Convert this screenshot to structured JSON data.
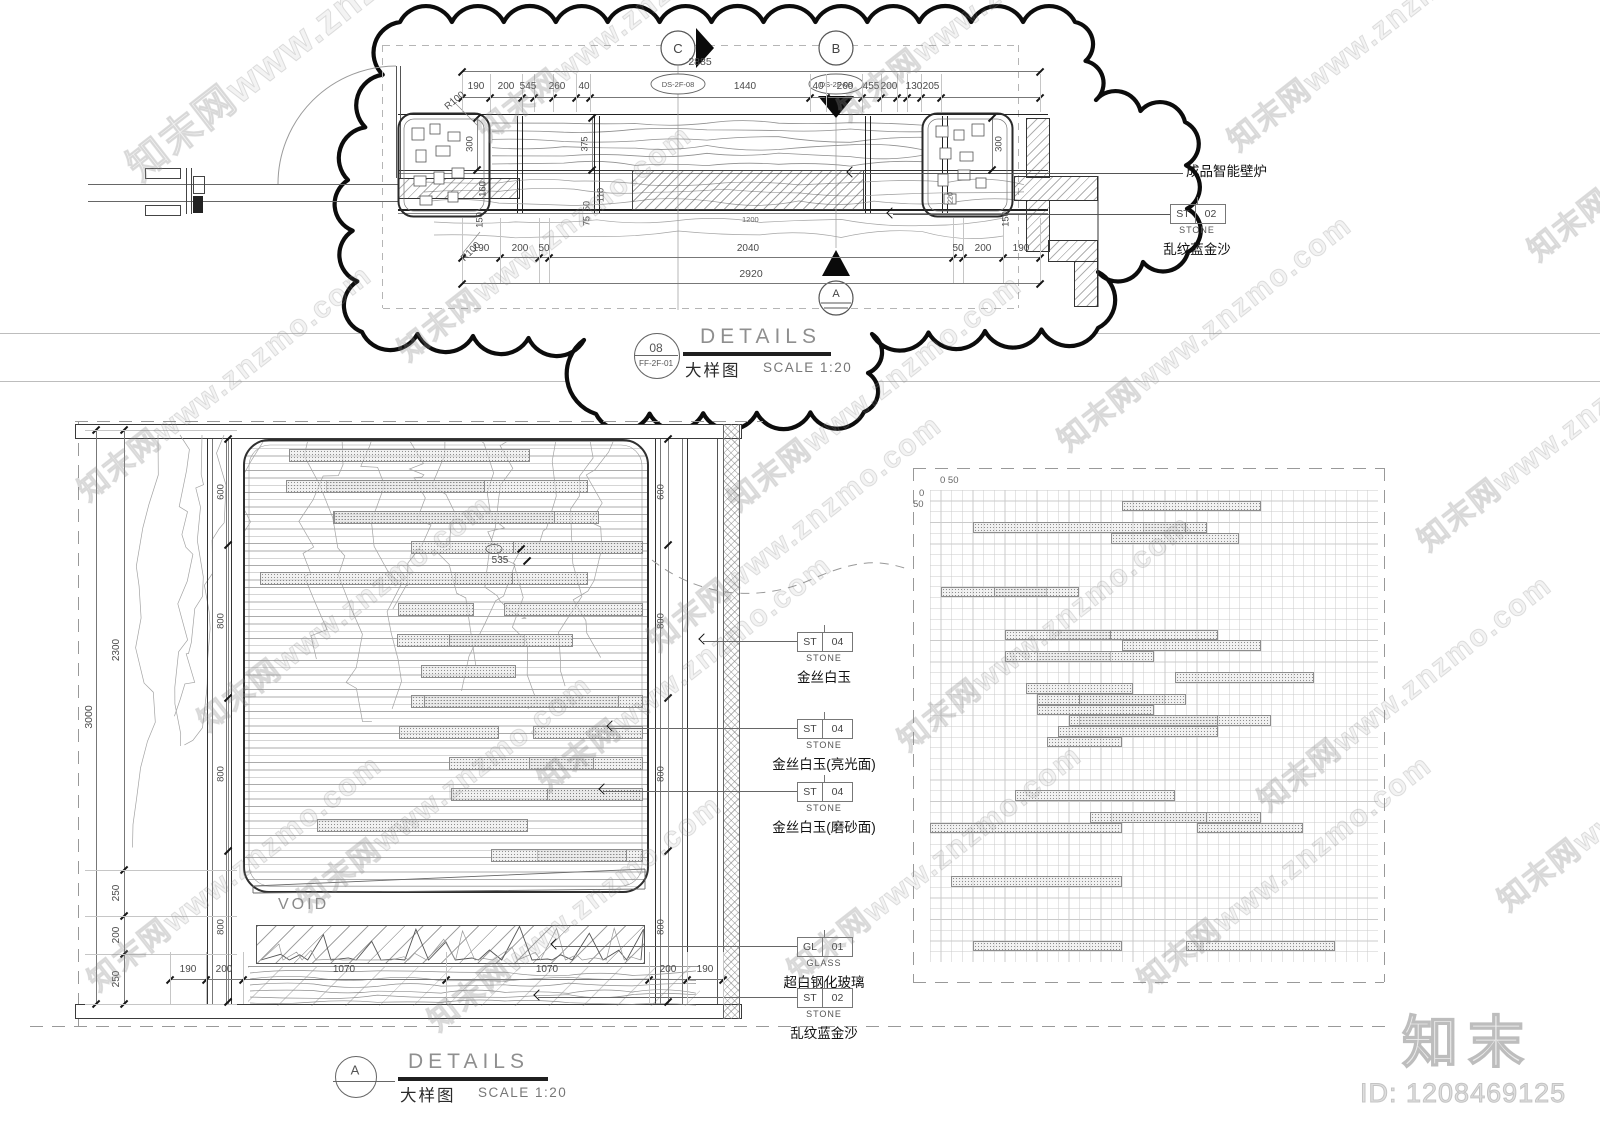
{
  "watermark": {
    "text": "知末网www.znzmo.com"
  },
  "branding": {
    "logo": "知末",
    "id_label": "ID: 1208469125"
  },
  "plan_detail": {
    "title": {
      "number": "08",
      "code": "FF-2F-01",
      "name": "DETAILS",
      "name_cn": "大样图",
      "scale": "SCALE 1:20"
    },
    "markers": [
      {
        "label": "C",
        "ref": "DS-2F-08"
      },
      {
        "label": "B",
        "ref": "DS-2F-08"
      },
      {
        "label": "A",
        "ref": ""
      }
    ],
    "callout_note": "成品智能壁炉",
    "material_tag": {
      "code": "ST",
      "num": "02",
      "type": "STONE",
      "name": "乱纹蓝金沙"
    },
    "dims": {
      "top_overall": "2885",
      "top_chain": [
        "190",
        "200",
        "545",
        "260",
        "40",
        "1440",
        "40",
        "260",
        "455",
        "200",
        "130",
        "205"
      ],
      "bottom_chain": [
        "190",
        "200",
        "50",
        "2040",
        "50",
        "200",
        "190"
      ],
      "bottom_overall": "2920",
      "left_rotated": [
        "R100",
        "300",
        "160",
        "150",
        "R100"
      ],
      "mid_rotated": [
        "375",
        "110",
        "50",
        "75"
      ],
      "right_rotated": [
        "300",
        "150",
        "220"
      ],
      "glass_width": "1200"
    }
  },
  "elevation_detail": {
    "title": {
      "letter": "A",
      "name": "DETAILS",
      "name_cn": "大样图",
      "scale": "SCALE 1:20"
    },
    "void_label": "VOID",
    "dims": {
      "overall": "3000",
      "left_chain": [
        "2300",
        "250",
        "200",
        "250"
      ],
      "column_chain": [
        "600",
        "800",
        "800",
        "800"
      ],
      "right_chain": [
        "600",
        "800",
        "800",
        "800"
      ],
      "bottom_chain": [
        "190",
        "200",
        "1070",
        "1070",
        "200",
        "190"
      ],
      "panel_dim": "535"
    },
    "tags": [
      {
        "code": "ST",
        "num": "04",
        "type": "STONE",
        "name": "金丝白玉"
      },
      {
        "code": "ST",
        "num": "04",
        "type": "STONE",
        "name": "金丝白玉(亮光面)"
      },
      {
        "code": "ST",
        "num": "04",
        "type": "STONE",
        "name": "金丝白玉(磨砂面)"
      },
      {
        "code": "GL",
        "num": "01",
        "type": "GLASS",
        "name": "超白钢化玻璃"
      },
      {
        "code": "ST",
        "num": "02",
        "type": "STONE",
        "name": "乱纹蓝金沙"
      }
    ]
  },
  "grid_detail": {
    "axis_labels": {
      "top": "0 50",
      "left_a": "0",
      "left_b": "50"
    }
  }
}
